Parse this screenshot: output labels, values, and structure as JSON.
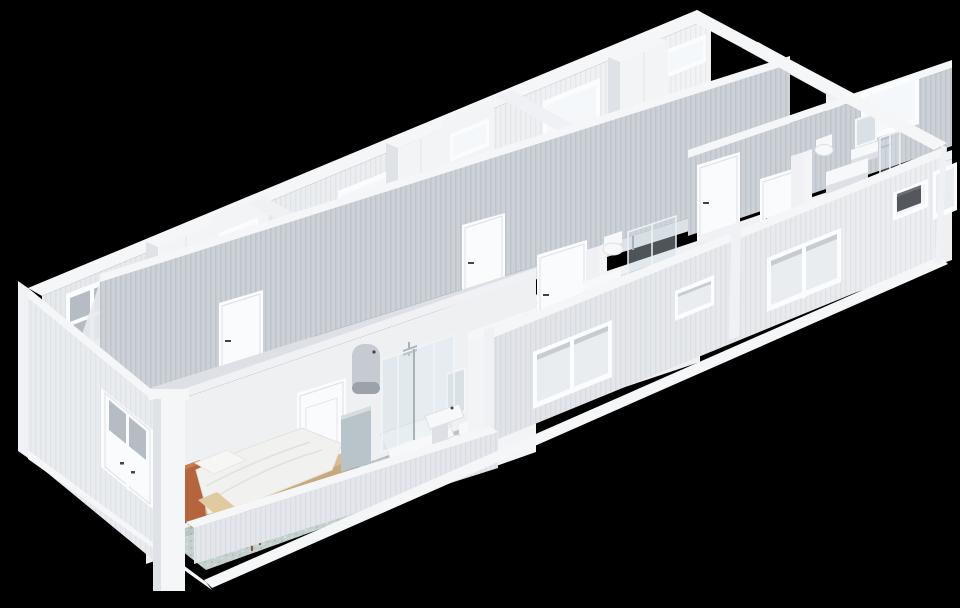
{
  "scene": {
    "title": "isometric-cutaway-render-of-modular-container-building",
    "background_color": "#000000",
    "view": "dollhouse cutaway, roof removed, viewed from upper left",
    "building": {
      "type": "modular container accommodation block",
      "exterior": [
        "ribbed sandwich-panel walls",
        "white trim bands",
        "white plinth skirt"
      ],
      "rooms": [
        {
          "name": "foreground-bedroom",
          "fixtures": [
            "single-bed-white-duvet",
            "terracotta-headboard",
            "wood-desk",
            "orange-stool",
            "interior-door"
          ]
        },
        {
          "name": "foreground-ensuite-bathroom",
          "fixtures": [
            "water-heater",
            "corner-glass-shower",
            "mirror",
            "washbasin",
            "toilet",
            "half-partition",
            "teal-speckled-floor"
          ]
        },
        {
          "name": "middle-room",
          "fixtures": [
            "interior-door",
            "ensuite-toilet",
            "ensuite-shower",
            "counter",
            "small-window"
          ]
        },
        {
          "name": "right-end-room",
          "fixtures": [
            "interior-door",
            "ensuite-toilet",
            "washbasin-with-mirror",
            "glass-partition",
            "counter",
            "vent-niche-with-ac-unit"
          ]
        },
        {
          "name": "far-room-1",
          "fixtures": [
            "glazed-double-door",
            "window",
            "wardrobe",
            "ensuite-window"
          ]
        },
        {
          "name": "far-room-2",
          "fixtures": [
            "window",
            "wardrobe",
            "ensuite-window",
            "corridor-door"
          ]
        },
        {
          "name": "far-room-3",
          "fixtures": [
            "window",
            "wardrobe",
            "ensuite-window",
            "corridor-door"
          ]
        },
        {
          "name": "far-room-4",
          "fixtures": [
            "window",
            "corridor-door"
          ]
        }
      ],
      "corridor": {
        "walls": "gray ribbed panels",
        "doors": 3
      }
    },
    "colors": {
      "background": "#000000",
      "trim_white": "#f4f6f8",
      "wall_ribbed_gray": "#ccd1d7",
      "wall_interior_white": "#eef0f2",
      "exterior_wall": "#e5e8eb",
      "end_wall": "#e9ecef",
      "floor_teal": "#c5d1ce",
      "floor_speckle": "#a9bcb8",
      "floor_gray": "#dde1e6",
      "window_bright": "#f5f8fa",
      "glazed_door_pane": "#b6bcc4",
      "glass_tint": "rgba(205,220,230,0.38)",
      "glass_tint_light": "rgba(215,228,236,0.30)",
      "wood": "#d8bd91",
      "wood_front": "#c7a97c",
      "wood_desk": "#e0caa0",
      "terracotta": "#b4653e",
      "terracotta_light": "#c97c53",
      "stool_orange": "#bc6b3d",
      "duvet_white": "#f1f1ef",
      "pillow_white": "#f6f6f4",
      "heater_gray": "#c6cbd1",
      "heater_cap": "#9ba2aa",
      "ac_unit_dark": "#54585e",
      "ac_unit_top": "#6a6f76",
      "metal_trim": "#a7b2bb",
      "mirror_pane": "#d9e1e6",
      "partition_bluegray": "#b9c3ca"
    }
  }
}
